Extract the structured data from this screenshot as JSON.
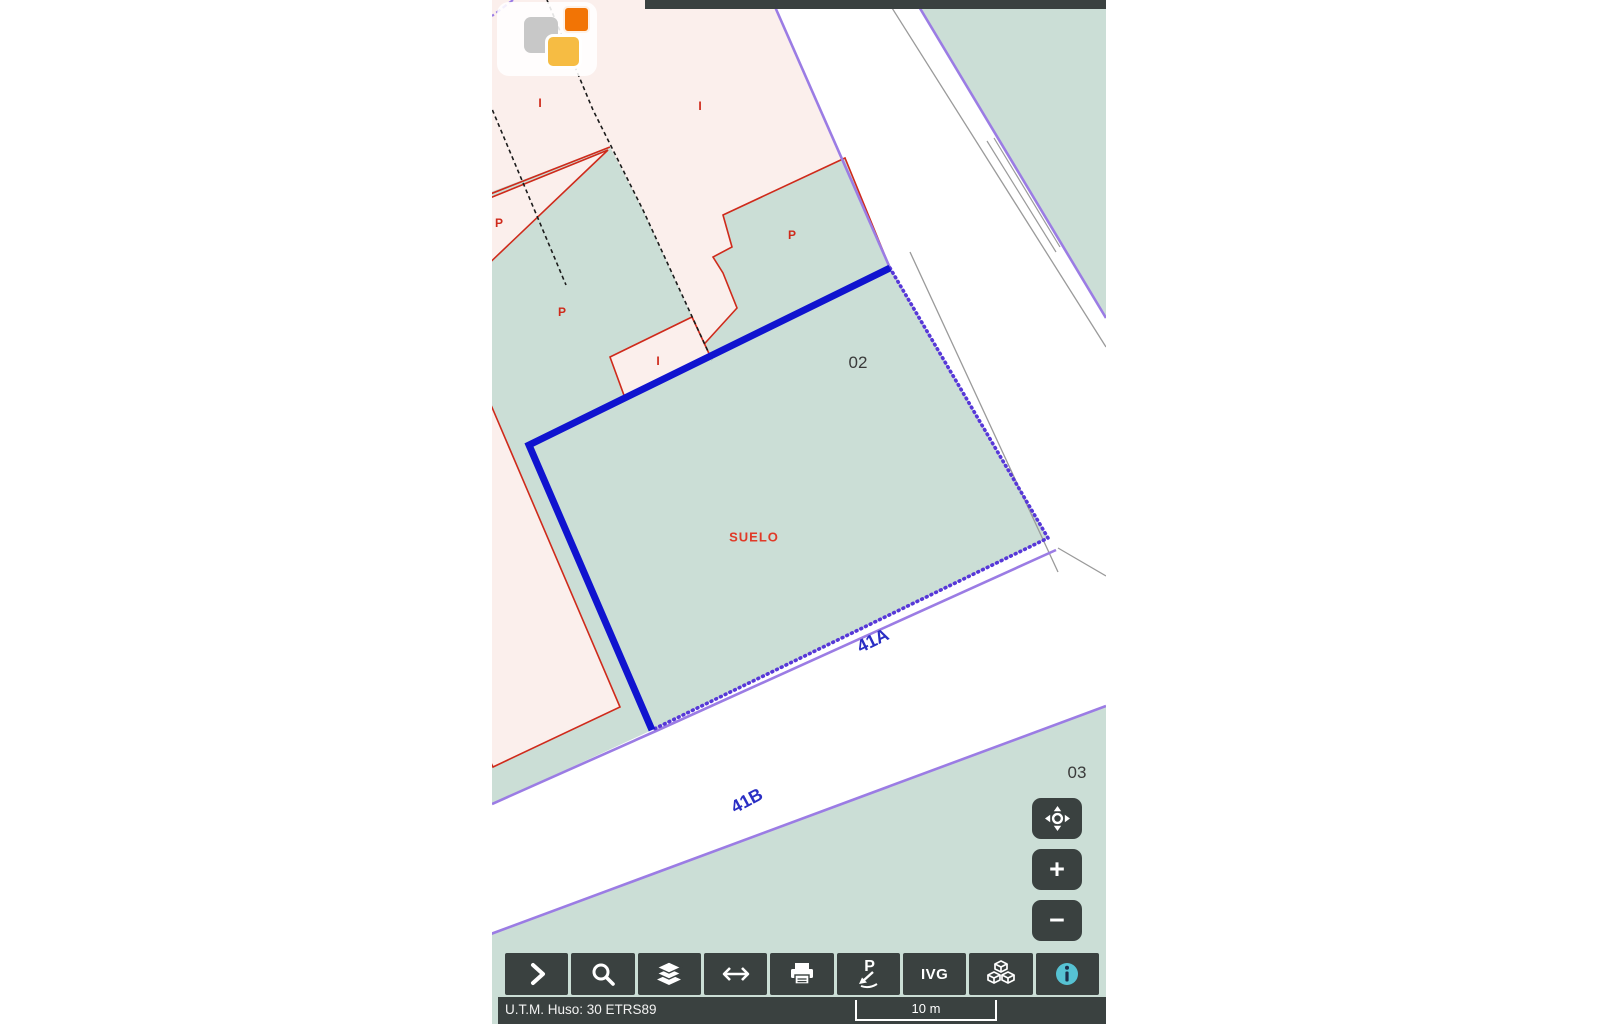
{
  "map": {
    "labels": {
      "suelo": "SUELO",
      "parcel02": "02",
      "parcel03": "03",
      "street41a": "41A",
      "street41b": "41B",
      "i1": "I",
      "i2": "I",
      "i3": "I",
      "p1": "P",
      "p2": "P",
      "p3": "P"
    },
    "colors": {
      "parcel_green": "#cbded6",
      "urban_pink": "#fbefec",
      "road_white": "#ffffff",
      "boundary_purple": "#9b7ce4",
      "subparcel_red": "#cf2a1b",
      "selection_blue": "#1013cf",
      "selection_dotted_blue": "#5738d8",
      "street_label_blue": "#2a2ec4",
      "toolbar_dark": "#3a4140",
      "info_teal": "#56c2d3",
      "logo_orange": "#f27405",
      "logo_amber": "#f6bc43",
      "logo_gray": "#c8c8c8"
    }
  },
  "toolbar": {
    "buttons": [
      {
        "name": "expand-panel",
        "icon": "chevron-right-icon"
      },
      {
        "name": "search",
        "icon": "magnifier-icon"
      },
      {
        "name": "layers",
        "icon": "layers-icon"
      },
      {
        "name": "measure",
        "icon": "double-arrow-icon"
      },
      {
        "name": "print",
        "icon": "printer-icon"
      },
      {
        "name": "point-reference",
        "icon": "p-arrow-icon",
        "label": "P"
      },
      {
        "name": "ivg",
        "label": "IVG"
      },
      {
        "name": "cartography-3d",
        "icon": "cubes-icon"
      },
      {
        "name": "info",
        "icon": "info-circle-icon"
      }
    ]
  },
  "map_controls": {
    "pan_icon": "pan-move-icon",
    "zoom_in_label": "+",
    "zoom_out_label": "−"
  },
  "status_bar": {
    "utm_text": "U.T.M. Huso: 30 ETRS89",
    "scale_text": "10 m"
  }
}
